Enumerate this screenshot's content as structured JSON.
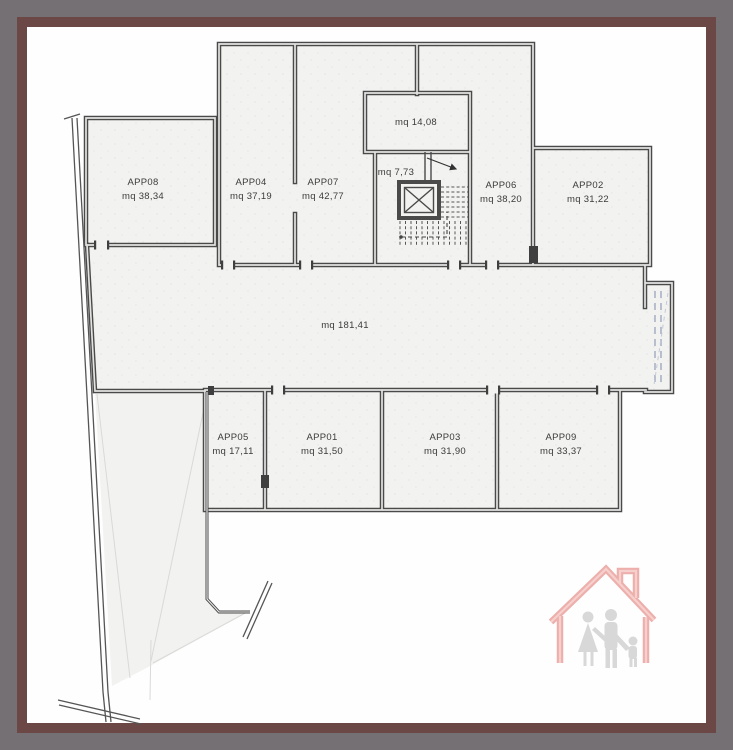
{
  "window": {
    "background_color": "#747074",
    "frame_color": "#6b4845",
    "canvas_color": "#fefefe"
  },
  "plan": {
    "type": "floor-plan",
    "units": "mq",
    "apartments": {
      "app08": {
        "code": "APP08",
        "area": "mq 38,34"
      },
      "app04": {
        "code": "APP04",
        "area": "mq 37,19"
      },
      "app07": {
        "code": "APP07",
        "area": "mq 42,77"
      },
      "app06": {
        "code": "APP06",
        "area": "mq 38,20"
      },
      "app02": {
        "code": "APP02",
        "area": "mq 31,22"
      },
      "app05": {
        "code": "APP05",
        "area": "mq 17,11"
      },
      "app01": {
        "code": "APP01",
        "area": "mq 31,50"
      },
      "app03": {
        "code": "APP03",
        "area": "mq 31,90"
      },
      "app09": {
        "code": "APP09",
        "area": "mq 33,37"
      }
    },
    "common_areas": {
      "cellar_room": "mq 14,08",
      "stair_landing": "mq 7,73",
      "corridor": "mq 181,41"
    },
    "colors": {
      "wall": "#4a4a4a",
      "floor": "#f2f2f0",
      "ramp_dashes": "#a9b2c6"
    }
  },
  "logo": {
    "house_color": "#eba29e",
    "family_color": "#cbcbcb"
  }
}
